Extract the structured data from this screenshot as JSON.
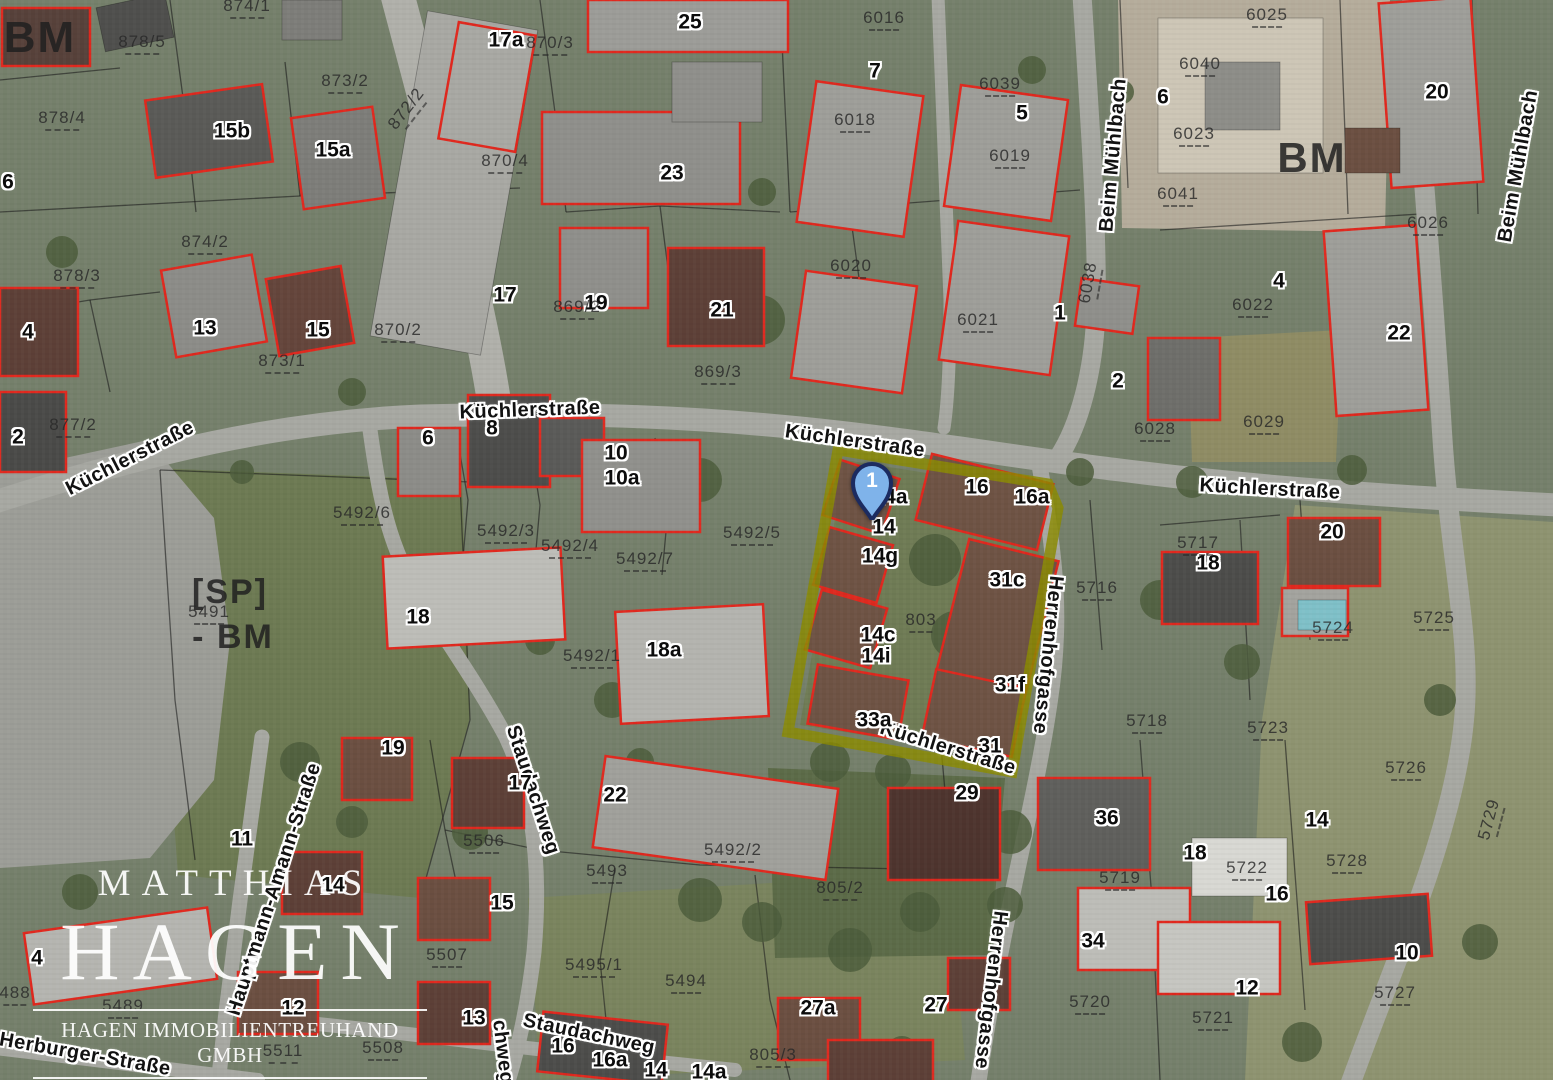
{
  "map": {
    "type": "aerial-cadastral-map",
    "colors": {
      "building_outline": "#e0281e",
      "parcel_line": "#1a1a1a",
      "highlight": "#8b8b00",
      "pin_fill": "#7fb3ea",
      "pin_border": "#1c2b60",
      "label_halo": "#ffffff"
    },
    "pin": {
      "label": "1",
      "x": 872,
      "y": 520
    },
    "highlight": {
      "points": "838,450 1048,484 1058,508 1012,772 788,732"
    },
    "logo": {
      "brand_top": "MATTHIAS",
      "brand_main": "HAGEN",
      "brand_sub": "HAGEN IMMOBILIENTREUHAND GMBH"
    },
    "labels": [
      {
        "t": "Küchlerstraße",
        "k": "street",
        "x": 130,
        "y": 458,
        "r": -27
      },
      {
        "t": "Küchlerstraße",
        "k": "street",
        "x": 530,
        "y": 410,
        "r": -2
      },
      {
        "t": "Küchlerstraße",
        "k": "street",
        "x": 855,
        "y": 441,
        "r": 8
      },
      {
        "t": "Küchlerstraße",
        "k": "street",
        "x": 1270,
        "y": 489,
        "r": 3
      },
      {
        "t": "Küchlerstraße",
        "k": "street",
        "x": 948,
        "y": 748,
        "r": 17
      },
      {
        "t": "Beim Mühlbach",
        "k": "street",
        "x": 1113,
        "y": 155,
        "r": -85
      },
      {
        "t": "Beim Mühlbach",
        "k": "street",
        "x": 1518,
        "y": 166,
        "r": -80
      },
      {
        "t": "Herrenhofgasse",
        "k": "street",
        "x": 1048,
        "y": 655,
        "r": 96
      },
      {
        "t": "Herrenhofgasse",
        "k": "street",
        "x": 991,
        "y": 990,
        "r": 97
      },
      {
        "t": "Staudachweg",
        "k": "street",
        "x": 533,
        "y": 790,
        "r": 72
      },
      {
        "t": "Staudachweg",
        "k": "street",
        "x": 589,
        "y": 1034,
        "r": 12
      },
      {
        "t": "chweg",
        "k": "street",
        "x": 503,
        "y": 1052,
        "r": 83
      },
      {
        "t": "Hauptmann-Amann-Straße",
        "k": "street",
        "x": 274,
        "y": 889,
        "r": -72
      },
      {
        "t": "f-Herburger-Straße",
        "k": "street",
        "x": 78,
        "y": 1053,
        "r": 10
      },
      {
        "t": "BM",
        "k": "big",
        "x": 40,
        "y": 38,
        "s": 44
      },
      {
        "t": "BM",
        "k": "big",
        "x": 1312,
        "y": 158,
        "s": 42
      },
      {
        "t": "[SP]",
        "k": "big",
        "x": 230,
        "y": 592,
        "s": 34
      },
      {
        "t": "- BM",
        "k": "big",
        "x": 233,
        "y": 637,
        "s": 34
      },
      {
        "t": "25",
        "k": "house",
        "x": 690,
        "y": 22
      },
      {
        "t": "17a",
        "k": "house",
        "x": 506,
        "y": 40
      },
      {
        "t": "15b",
        "k": "house",
        "x": 232,
        "y": 131
      },
      {
        "t": "15a",
        "k": "house",
        "x": 333,
        "y": 150
      },
      {
        "t": "6",
        "k": "house",
        "x": 8,
        "y": 182
      },
      {
        "t": "7",
        "k": "house",
        "x": 875,
        "y": 71
      },
      {
        "t": "5",
        "k": "house",
        "x": 1022,
        "y": 113
      },
      {
        "t": "6",
        "k": "house",
        "x": 1163,
        "y": 97
      },
      {
        "t": "20",
        "k": "house",
        "x": 1437,
        "y": 92
      },
      {
        "t": "23",
        "k": "house",
        "x": 672,
        "y": 173
      },
      {
        "t": "13",
        "k": "house",
        "x": 205,
        "y": 328
      },
      {
        "t": "15",
        "k": "house",
        "x": 318,
        "y": 330
      },
      {
        "t": "17",
        "k": "house",
        "x": 505,
        "y": 295
      },
      {
        "t": "19",
        "k": "house",
        "x": 596,
        "y": 303
      },
      {
        "t": "21",
        "k": "house",
        "x": 722,
        "y": 310
      },
      {
        "t": "4",
        "k": "house",
        "x": 28,
        "y": 332
      },
      {
        "t": "2",
        "k": "house",
        "x": 18,
        "y": 437
      },
      {
        "t": "1",
        "k": "house",
        "x": 1060,
        "y": 313
      },
      {
        "t": "4",
        "k": "house",
        "x": 1279,
        "y": 281
      },
      {
        "t": "22",
        "k": "house",
        "x": 1399,
        "y": 333
      },
      {
        "t": "2",
        "k": "house",
        "x": 1118,
        "y": 381
      },
      {
        "t": "20",
        "k": "house",
        "x": 1332,
        "y": 532
      },
      {
        "t": "18",
        "k": "house",
        "x": 1208,
        "y": 563
      },
      {
        "t": "6",
        "k": "house",
        "x": 428,
        "y": 438
      },
      {
        "t": "8",
        "k": "house",
        "x": 492,
        "y": 428
      },
      {
        "t": "10",
        "k": "house",
        "x": 616,
        "y": 453
      },
      {
        "t": "10a",
        "k": "house",
        "x": 622,
        "y": 478
      },
      {
        "t": "16",
        "k": "house",
        "x": 977,
        "y": 487
      },
      {
        "t": "16a",
        "k": "house",
        "x": 1032,
        "y": 497
      },
      {
        "t": "14a",
        "k": "house",
        "x": 890,
        "y": 497
      },
      {
        "t": "14",
        "k": "house",
        "x": 884,
        "y": 527
      },
      {
        "t": "14g",
        "k": "house",
        "x": 880,
        "y": 556
      },
      {
        "t": "31c",
        "k": "house",
        "x": 1007,
        "y": 580
      },
      {
        "t": "14c",
        "k": "house",
        "x": 878,
        "y": 635
      },
      {
        "t": "14i",
        "k": "house",
        "x": 876,
        "y": 656
      },
      {
        "t": "31f",
        "k": "house",
        "x": 1010,
        "y": 685
      },
      {
        "t": "33a",
        "k": "house",
        "x": 874,
        "y": 720
      },
      {
        "t": "31",
        "k": "house",
        "x": 990,
        "y": 746
      },
      {
        "t": "18",
        "k": "house",
        "x": 418,
        "y": 617
      },
      {
        "t": "18a",
        "k": "house",
        "x": 664,
        "y": 650
      },
      {
        "t": "19",
        "k": "house",
        "x": 393,
        "y": 748
      },
      {
        "t": "17",
        "k": "house",
        "x": 520,
        "y": 783
      },
      {
        "t": "22",
        "k": "house",
        "x": 615,
        "y": 795
      },
      {
        "t": "15",
        "k": "house",
        "x": 502,
        "y": 903
      },
      {
        "t": "13",
        "k": "house",
        "x": 474,
        "y": 1018
      },
      {
        "t": "16",
        "k": "house",
        "x": 563,
        "y": 1046
      },
      {
        "t": "16a",
        "k": "house",
        "x": 610,
        "y": 1060
      },
      {
        "t": "14",
        "k": "house",
        "x": 656,
        "y": 1070
      },
      {
        "t": "14a",
        "k": "house",
        "x": 709,
        "y": 1072
      },
      {
        "t": "27a",
        "k": "house",
        "x": 818,
        "y": 1008
      },
      {
        "t": "27",
        "k": "house",
        "x": 936,
        "y": 1005
      },
      {
        "t": "29",
        "k": "house",
        "x": 967,
        "y": 793
      },
      {
        "t": "36",
        "k": "house",
        "x": 1107,
        "y": 818
      },
      {
        "t": "18",
        "k": "house",
        "x": 1195,
        "y": 853
      },
      {
        "t": "16",
        "k": "house",
        "x": 1277,
        "y": 894
      },
      {
        "t": "34",
        "k": "house",
        "x": 1093,
        "y": 941
      },
      {
        "t": "12",
        "k": "house",
        "x": 1247,
        "y": 988
      },
      {
        "t": "11",
        "k": "house",
        "x": 242,
        "y": 839
      },
      {
        "t": "14",
        "k": "house",
        "x": 333,
        "y": 885
      },
      {
        "t": "12",
        "k": "house",
        "x": 293,
        "y": 1008
      },
      {
        "t": "4",
        "k": "house",
        "x": 37,
        "y": 958
      },
      {
        "t": "14",
        "k": "house",
        "x": 1317,
        "y": 820
      },
      {
        "t": "10",
        "k": "house",
        "x": 1407,
        "y": 953
      },
      {
        "t": "878/5",
        "k": "parcel",
        "x": 142,
        "y": 44
      },
      {
        "t": "874/1",
        "k": "parcel",
        "x": 247,
        "y": 8
      },
      {
        "t": "873/2",
        "k": "parcel",
        "x": 345,
        "y": 83
      },
      {
        "t": "872/2",
        "k": "parcel",
        "x": 408,
        "y": 110,
        "r": -52
      },
      {
        "t": "878/4",
        "k": "parcel",
        "x": 62,
        "y": 120
      },
      {
        "t": "870/3",
        "k": "parcel",
        "x": 550,
        "y": 45
      },
      {
        "t": "870/4",
        "k": "parcel",
        "x": 505,
        "y": 163
      },
      {
        "t": "874/2",
        "k": "parcel",
        "x": 205,
        "y": 244
      },
      {
        "t": "878/3",
        "k": "parcel",
        "x": 77,
        "y": 278
      },
      {
        "t": "873/1",
        "k": "parcel",
        "x": 282,
        "y": 363
      },
      {
        "t": "870/2",
        "k": "parcel",
        "x": 398,
        "y": 332
      },
      {
        "t": "869/2",
        "k": "parcel",
        "x": 577,
        "y": 309
      },
      {
        "t": "869/3",
        "k": "parcel",
        "x": 718,
        "y": 374
      },
      {
        "t": "877/2",
        "k": "parcel",
        "x": 73,
        "y": 427
      },
      {
        "t": "6016",
        "k": "parcel",
        "x": 884,
        "y": 20
      },
      {
        "t": "6018",
        "k": "parcel",
        "x": 855,
        "y": 122
      },
      {
        "t": "6039",
        "k": "parcel",
        "x": 1000,
        "y": 86
      },
      {
        "t": "6019",
        "k": "parcel",
        "x": 1010,
        "y": 158
      },
      {
        "t": "6020",
        "k": "parcel",
        "x": 851,
        "y": 268
      },
      {
        "t": "6021",
        "k": "parcel",
        "x": 978,
        "y": 322
      },
      {
        "t": "6025",
        "k": "parcel",
        "x": 1267,
        "y": 17
      },
      {
        "t": "6040",
        "k": "parcel",
        "x": 1200,
        "y": 66
      },
      {
        "t": "6023",
        "k": "parcel",
        "x": 1194,
        "y": 136
      },
      {
        "t": "6041",
        "k": "parcel",
        "x": 1178,
        "y": 196
      },
      {
        "t": "6026",
        "k": "parcel",
        "x": 1428,
        "y": 225
      },
      {
        "t": "6022",
        "k": "parcel",
        "x": 1253,
        "y": 307
      },
      {
        "t": "6038",
        "k": "parcel",
        "x": 1090,
        "y": 283,
        "r": -80
      },
      {
        "t": "6028",
        "k": "parcel",
        "x": 1155,
        "y": 431
      },
      {
        "t": "6029",
        "k": "parcel",
        "x": 1264,
        "y": 424
      },
      {
        "t": "5492/6",
        "k": "parcel",
        "x": 362,
        "y": 515
      },
      {
        "t": "5492/3",
        "k": "parcel",
        "x": 506,
        "y": 533
      },
      {
        "t": "5492/4",
        "k": "parcel",
        "x": 570,
        "y": 548
      },
      {
        "t": "5492/7",
        "k": "parcel",
        "x": 645,
        "y": 561
      },
      {
        "t": "5492/5",
        "k": "parcel",
        "x": 752,
        "y": 535
      },
      {
        "t": "5492/1",
        "k": "parcel",
        "x": 592,
        "y": 658
      },
      {
        "t": "803",
        "k": "parcel",
        "x": 921,
        "y": 622
      },
      {
        "t": "5717",
        "k": "parcel",
        "x": 1198,
        "y": 545
      },
      {
        "t": "5716",
        "k": "parcel",
        "x": 1097,
        "y": 590
      },
      {
        "t": "5724",
        "k": "parcel",
        "x": 1333,
        "y": 630
      },
      {
        "t": "5725",
        "k": "parcel",
        "x": 1434,
        "y": 620
      },
      {
        "t": "5718",
        "k": "parcel",
        "x": 1147,
        "y": 723
      },
      {
        "t": "5723",
        "k": "parcel",
        "x": 1268,
        "y": 730
      },
      {
        "t": "5726",
        "k": "parcel",
        "x": 1406,
        "y": 770
      },
      {
        "t": "5729",
        "k": "parcel",
        "x": 1491,
        "y": 820,
        "r": -75
      },
      {
        "t": "5728",
        "k": "parcel",
        "x": 1347,
        "y": 863
      },
      {
        "t": "5727",
        "k": "parcel",
        "x": 1395,
        "y": 995
      },
      {
        "t": "5719",
        "k": "parcel",
        "x": 1120,
        "y": 880
      },
      {
        "t": "5722",
        "k": "parcel",
        "x": 1247,
        "y": 870
      },
      {
        "t": "5720",
        "k": "parcel",
        "x": 1090,
        "y": 1004
      },
      {
        "t": "5721",
        "k": "parcel",
        "x": 1213,
        "y": 1020
      },
      {
        "t": "5506",
        "k": "parcel",
        "x": 484,
        "y": 843
      },
      {
        "t": "5493",
        "k": "parcel",
        "x": 607,
        "y": 873
      },
      {
        "t": "5492/2",
        "k": "parcel",
        "x": 733,
        "y": 852
      },
      {
        "t": "805/2",
        "k": "parcel",
        "x": 840,
        "y": 890
      },
      {
        "t": "5507",
        "k": "parcel",
        "x": 447,
        "y": 957
      },
      {
        "t": "5495/1",
        "k": "parcel",
        "x": 594,
        "y": 967
      },
      {
        "t": "5494",
        "k": "parcel",
        "x": 686,
        "y": 983
      },
      {
        "t": "805/3",
        "k": "parcel",
        "x": 773,
        "y": 1057
      },
      {
        "t": "5489",
        "k": "parcel",
        "x": 123,
        "y": 1008
      },
      {
        "t": "5511",
        "k": "parcel",
        "x": 283,
        "y": 1053
      },
      {
        "t": "5508",
        "k": "parcel",
        "x": 383,
        "y": 1050
      },
      {
        "t": "488",
        "k": "parcel",
        "x": 15,
        "y": 995
      },
      {
        "t": "5491",
        "k": "parcel",
        "x": 209,
        "y": 614
      }
    ]
  }
}
